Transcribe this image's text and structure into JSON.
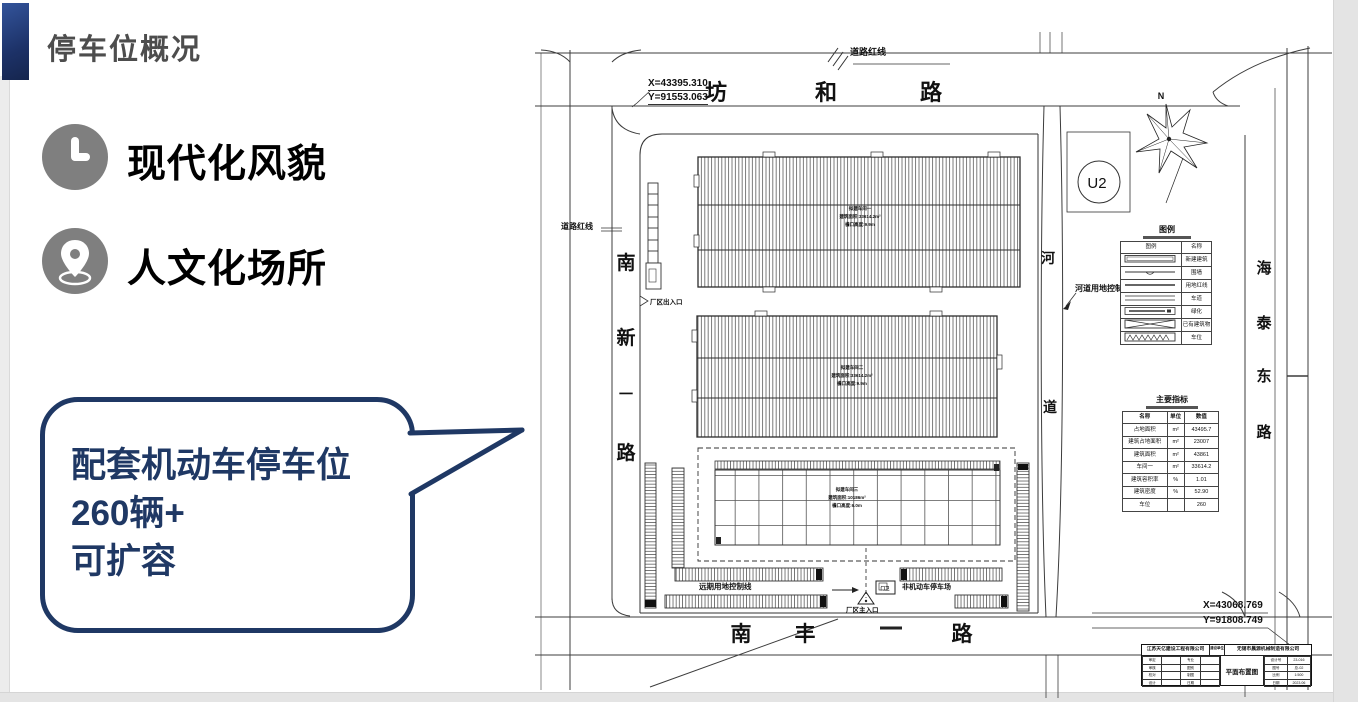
{
  "slide": {
    "title": "停车位概况",
    "features": [
      {
        "label": "现代化风貌"
      },
      {
        "label": "人文化场所"
      }
    ],
    "callout": {
      "line1": "配套机动车停车位",
      "line2": "260辆+",
      "line3": "可扩容"
    }
  },
  "plan": {
    "road_top": {
      "c1": "坊",
      "c2": "和",
      "c3": "路"
    },
    "road_left": {
      "c1": "南",
      "c2": "新",
      "c3": "一",
      "c4": "路"
    },
    "road_bottom": {
      "c1": "南",
      "c2": "丰",
      "c3": "路"
    },
    "road_right": {
      "c1": "海",
      "c2": "泰",
      "c3": "东",
      "c4": "路"
    },
    "river": {
      "c1": "河",
      "c2": "道"
    },
    "north_label": "N",
    "u2_label": "U2",
    "coord_top_x": "X=43395.310",
    "coord_top_y": "Y=91553.063",
    "coord_bottom_x": "X=43068.769",
    "coord_bottom_y": "Y=91808.749",
    "labels": {
      "road_redline_top": "道路红线",
      "road_redline_left": "道路红线",
      "river_blueline": "河道用地控制蓝线",
      "future_control": "远期用地控制线",
      "entrance_side": "厂区出入口",
      "entrance_main": "厂区主入口",
      "bike_parking": "非机动车停车场",
      "guard": "门卫"
    },
    "b1": {
      "l1": "拟建车间一",
      "l2": "建筑面积:33614.2m²",
      "l3": "檐口高度:9.9m"
    },
    "b2": {
      "l1": "拟建车间二",
      "l2": "建筑面积:33614.2m²",
      "l3": "檐口高度:9.9m"
    },
    "b3": {
      "l1": "拟建车间三",
      "l2": "建筑面积:10186m²",
      "l3": "檐口高度:6.0m"
    },
    "legend": {
      "title": "图例",
      "header": [
        "图例",
        "名称"
      ],
      "rows": [
        "新建建筑",
        "围墙",
        "用地红线",
        "车道",
        "绿化",
        "已有建筑物",
        "车位"
      ]
    },
    "indicators": {
      "title": "主要指标",
      "header": [
        "名称",
        "单位",
        "数值"
      ],
      "rows": [
        [
          "占地面积",
          "m²",
          "43495.7"
        ],
        [
          "建筑占地面积",
          "m²",
          "23007"
        ],
        [
          "建筑面积",
          "m²",
          "43861"
        ],
        [
          "车间一",
          "m²",
          "33614.2"
        ],
        [
          "建筑容积率",
          "%",
          "1.01"
        ],
        [
          "建筑密度",
          "%",
          "52.90"
        ],
        [
          "车位",
          "",
          "260"
        ]
      ]
    },
    "title_block": {
      "design_co": "江苏天亿建设工程有限公司",
      "mid_label": "建设单位",
      "owner_co": "无锡市晨源机械制造有限公司",
      "drawing_title": "平面布置图",
      "left_a": [
        "审定",
        "审核",
        "校对",
        "设计"
      ],
      "left_b": [
        "专业",
        "图别",
        "制图",
        "日期"
      ],
      "right_labels": [
        "设计号",
        "图号",
        "比例",
        "日期"
      ],
      "right_values": [
        "23-016",
        "总-02",
        "1:500",
        "2023.06"
      ]
    }
  }
}
